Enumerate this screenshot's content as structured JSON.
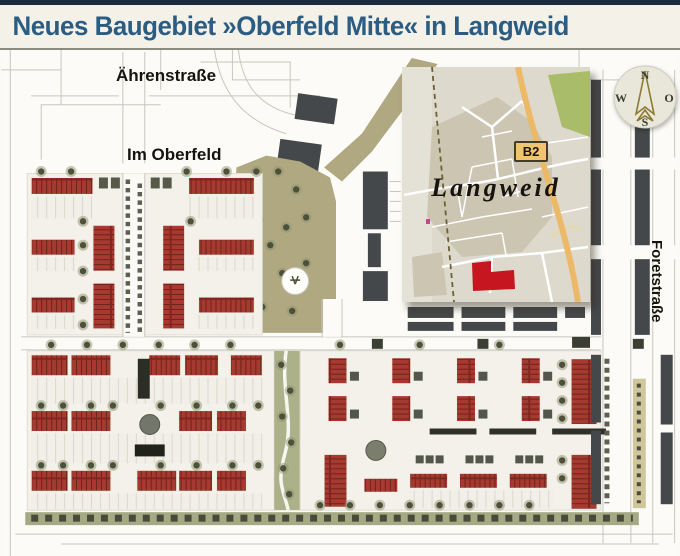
{
  "header": {
    "title": "Neues Baugebiet »Oberfeld Mitte« in Langweid"
  },
  "plan": {
    "street_labels": {
      "aehrenstrasse": "Ährenstraße",
      "im_oberfeld": "Im Oberfeld",
      "foretstrasse": "Foretstraße"
    }
  },
  "inset_map": {
    "town": "Langweid",
    "road_badge": "B2"
  },
  "compass": {
    "north": "N",
    "east": "O",
    "south": "S",
    "west": "W"
  },
  "colors": {
    "topbar_navy": "#1d2c3c",
    "header_bg": "#f4f1e9",
    "title_blue": "#2b5c82",
    "roof_red": "#a63a30",
    "site_red": "#c6161f",
    "b2_orange": "#ecb968",
    "b2_badge_bg": "#f3c46f",
    "park_olive": "#b0a881",
    "hedge_green": "#a5aa85",
    "dark_building": "#45484a",
    "inset_bg": "#ddd9cc",
    "inset_builtup": "#cbc5b2",
    "inset_green": "#a9bc6a",
    "compass_gold": "#8c7a30"
  }
}
